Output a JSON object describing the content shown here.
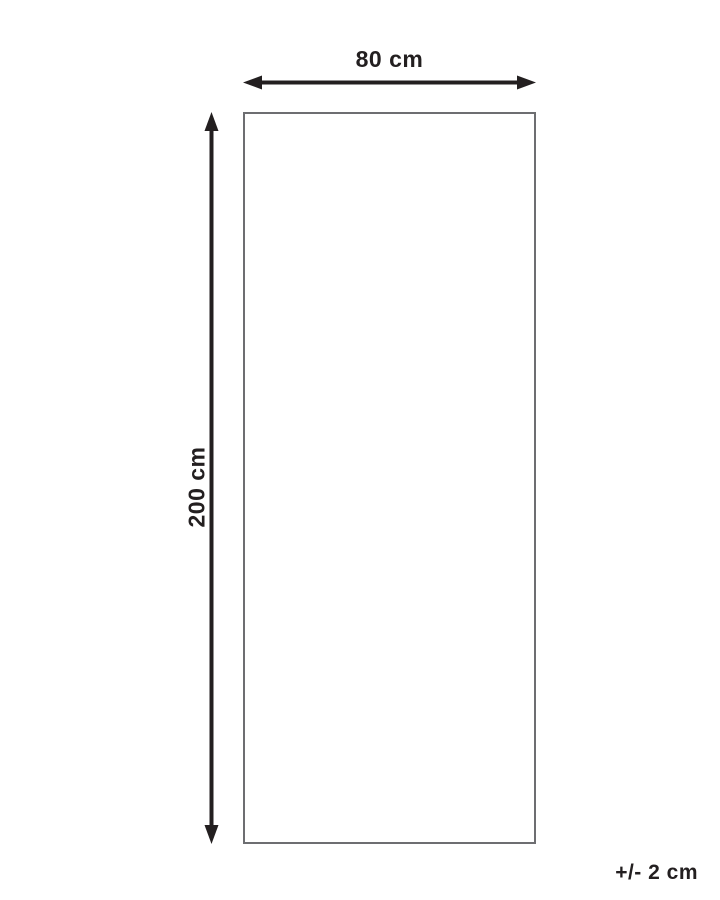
{
  "diagram": {
    "title": "product-dimension-diagram",
    "width_label": "80 cm",
    "height_label": "200 cm",
    "tolerance_label": "+/- 2 cm",
    "colors": {
      "arrow": "#231f20",
      "outline": "#6d6e71",
      "background": "#ffffff"
    }
  }
}
